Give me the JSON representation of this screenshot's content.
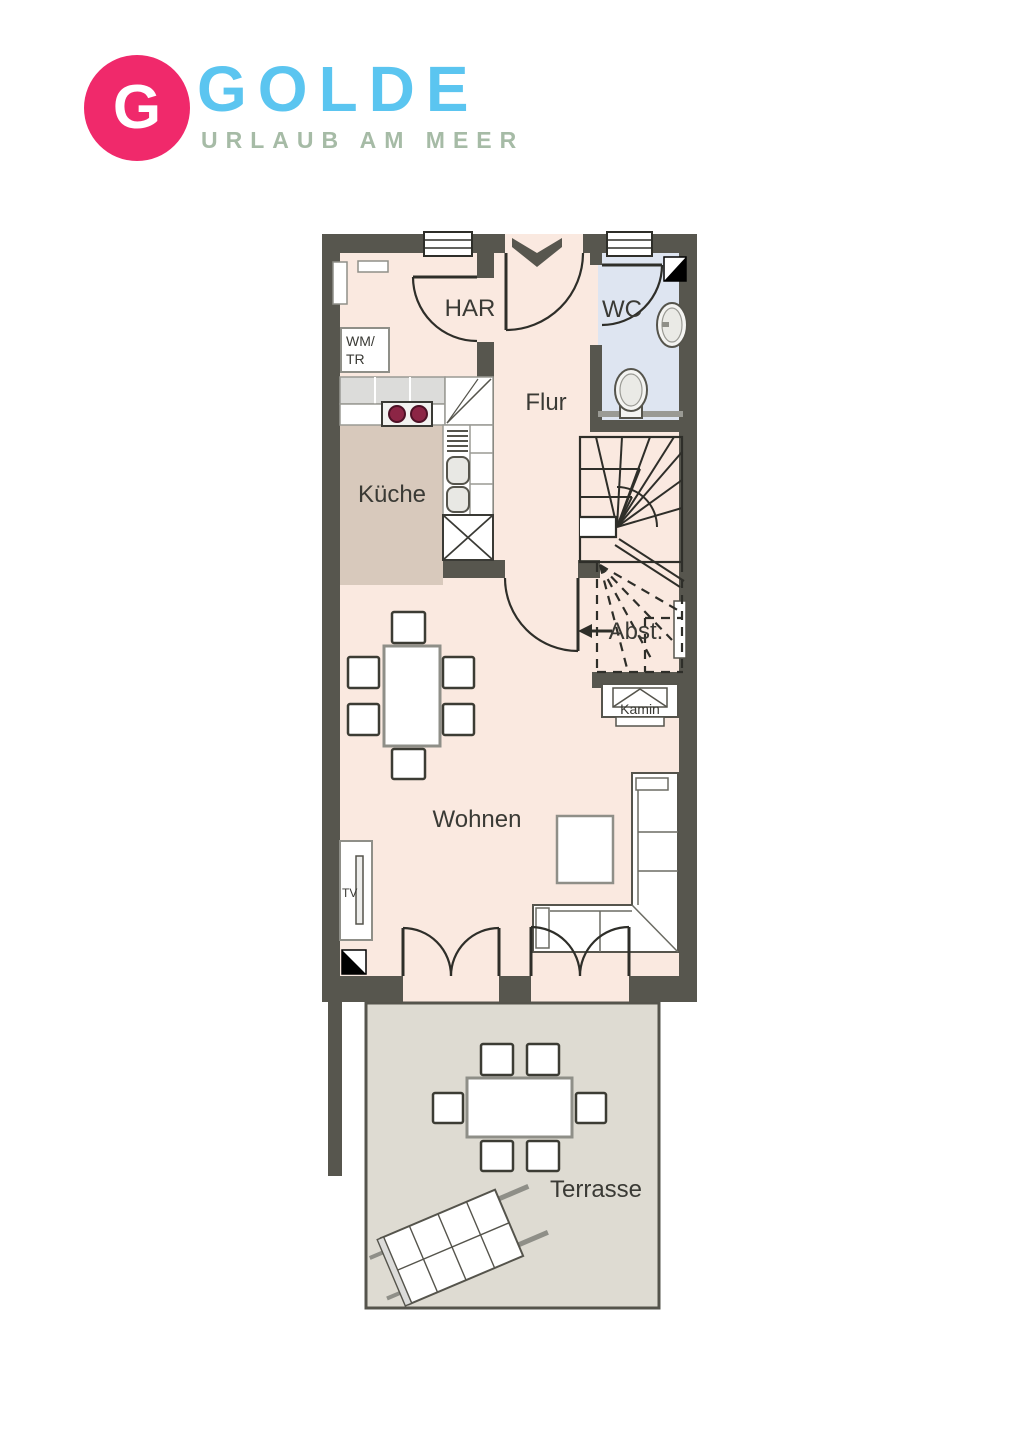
{
  "brand": {
    "monogram": "G",
    "name": "GOLDE",
    "tagline": "URLAUB AM MEER",
    "circle_color": "#f0296b",
    "name_color": "#5bc5f0",
    "tagline_color": "#a6bba6"
  },
  "floor_plan": {
    "rooms": {
      "har": {
        "label": "HAR"
      },
      "wc": {
        "label": "WC"
      },
      "flur": {
        "label": "Flur"
      },
      "kueche": {
        "label": "Küche"
      },
      "abst": {
        "label": "Abst."
      },
      "kamin": {
        "label": "Kamin"
      },
      "wohnen": {
        "label": "Wohnen"
      },
      "terrasse": {
        "label": "Terrasse"
      }
    },
    "appliances": {
      "washer_line1": "WM/",
      "washer_line2": "TR",
      "tv": "TV"
    },
    "colors": {
      "wall": "#57564e",
      "floor": "#fae9e0",
      "kitchen_floor": "#d8c9bc",
      "wc_floor": "#dee5f1",
      "terrace_floor": "#dedbd2",
      "stove_burner": "#8c2545",
      "outline_dark": "#2e2e29",
      "outline_gray": "#8f8f88"
    }
  }
}
